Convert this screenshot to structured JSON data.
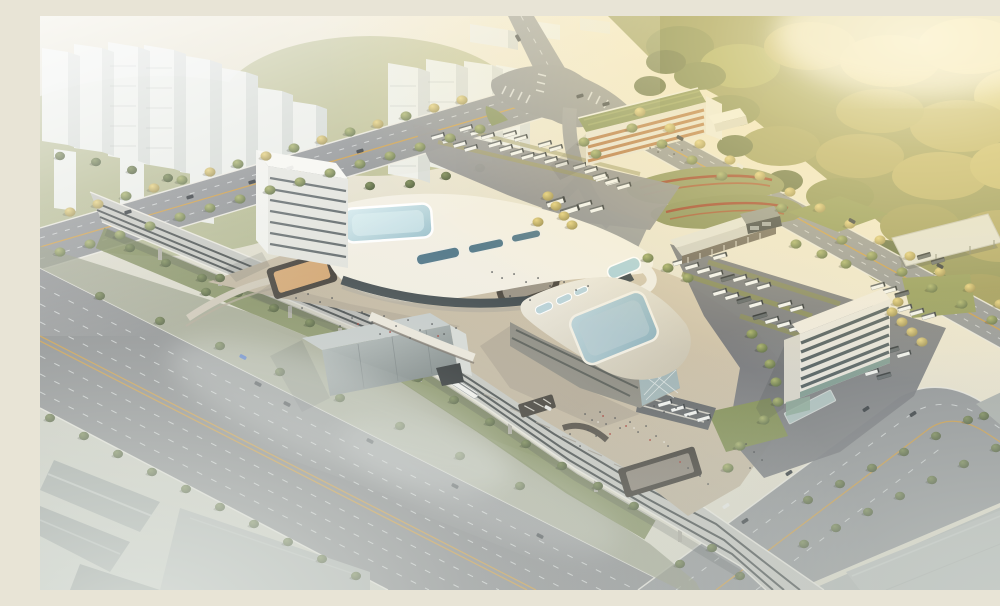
{
  "scene": {
    "description": "Oblique aerial architectural rendering of a modern intermodal transit hub: two sweeping white terminal buildings with blue rooftop skylights straddling an elevated rail viaduct with a high-speed train, surrounded by bus depots, a green-roofed parking garage, a striped office block, landscaped flower berms, wide boulevards with a large intersection, hazy residential towers to the northwest, a sunlit golden forest to the northeast, and misty warehouse districts in the foreground corners",
    "lighting": "hazy golden daylight from the upper right",
    "view": "bird's-eye oblique"
  },
  "labels": {
    "image": "Aerial rendering of a transit hub complex",
    "cityTowers": "hazy residential tower cluster",
    "forest": "sunlit golden forest",
    "boulevard": "northwest boulevard",
    "intersection": "main road intersection",
    "northRoad": "north access road",
    "forestRoad": "forest edge road",
    "arterial": "foreground arterial road",
    "crossStreet": "southeast cross street",
    "accessRoad": "site access road",
    "railCorridor": "elevated rail viaduct corridor",
    "train": "high-speed train",
    "plaza": "station plaza",
    "courtyards": "sunken plaza courtyards",
    "terminal1": "main terminal building with skylight roof",
    "terminal1Tower": "terminal office tower",
    "terminal2": "south terminal building with skylight roof",
    "linkRoof": "curved link canopy between terminals",
    "garage": "parking structure with green roof",
    "busLotNorth": "north bus parking lot",
    "busDepot": "east bus depot",
    "busBays": "terminal bus bays",
    "shed": "long maintenance shed",
    "canopy": "large depot canopy",
    "darkShed": "small service canopy",
    "whiteShed": "small white shed",
    "office": "striped office building",
    "concourseBox": "concourse box over tracks",
    "berms": "landscaped berms with red flowers",
    "lawns": "lawn panels",
    "shelter": "glass bus shelter",
    "industrialSW": "misty southwest industrial buildings",
    "warehousesSE": "misty southeast warehouse roofs",
    "trees": "street and landscape trees",
    "pedestrians": "pedestrians on plazas",
    "vehicles": "cars and buses",
    "fog": "drifting mist",
    "sun": "golden sun haze"
  },
  "palette": {
    "haze_gold": "#f6ecd2",
    "mist_gray": "#c2c6bc",
    "terminal_roof": "#f3efe3",
    "skylight_blue": "#9fc3cd",
    "skylight_slit": "#54798a",
    "plaza_tan": "#cfc2aa",
    "asphalt": "#87898b",
    "road_gray": "#8d9092",
    "lane_yellow": "#d09a3a",
    "forest_green": "#8e9156",
    "forest_gold": "#d3c171",
    "tree_olive": "#5a6a41",
    "viaduct_gray": "#c4c5bf",
    "track_dark": "#33383a",
    "garage_orange": "#b06a33",
    "roof_green": "#7d8b50",
    "flower_red": "#9a3c22",
    "train_teal": "#9fe8ea",
    "car_blue": "#3b67c4",
    "window_dark": "#4e5a5c",
    "warehouse_gray": "#aab0ac",
    "shadow": "#2e3436"
  }
}
